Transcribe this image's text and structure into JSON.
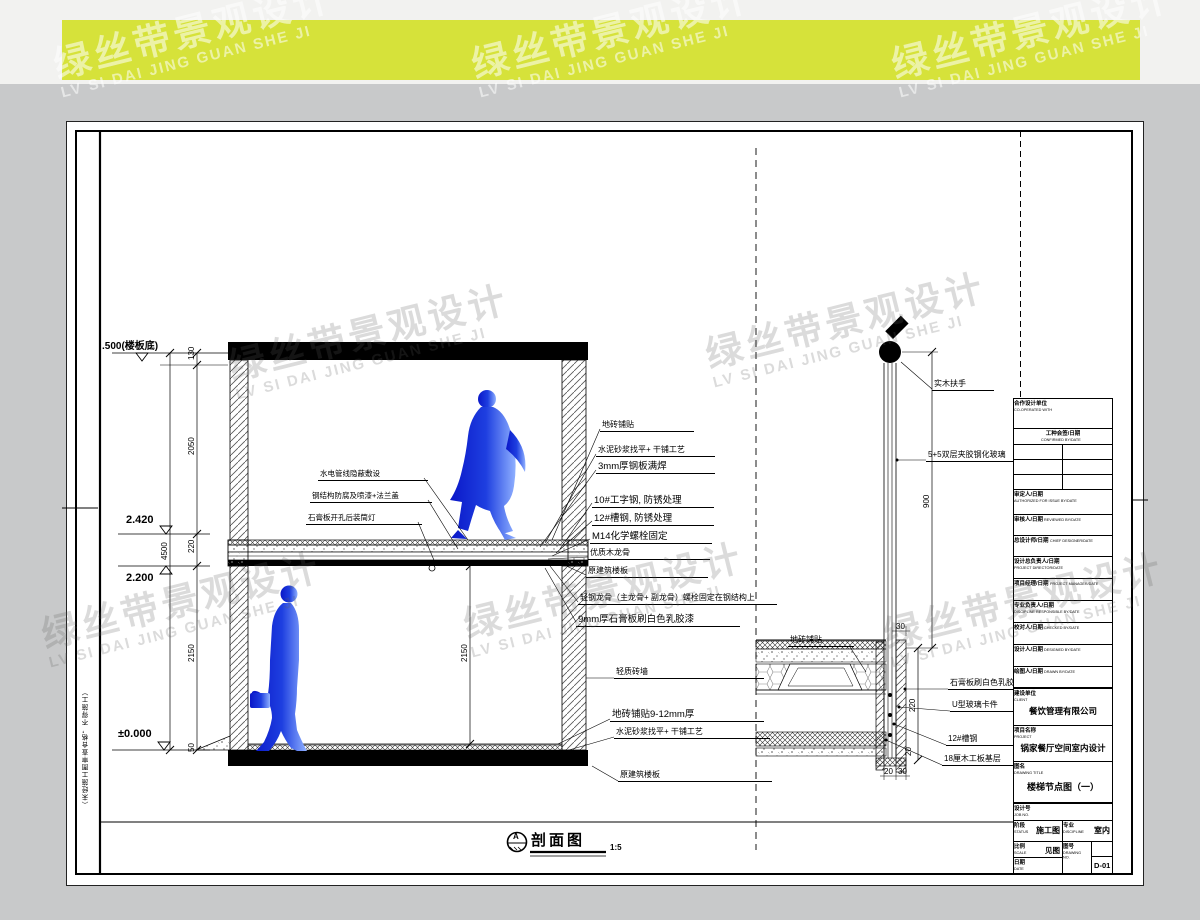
{
  "watermark": {
    "cn": "绿丝带景观设计",
    "en": "LV SI DAI JING GUAN SHE JI"
  },
  "elev": {
    "top": ".500(楼板底)",
    "mid_upper": "2.420",
    "mid_lower": "2.200",
    "zero": "±0.000"
  },
  "dims_left": {
    "s130": "130",
    "s2050": "2050",
    "s220": "220",
    "s2150": "2150",
    "s50": "50",
    "total": "4500"
  },
  "sec_mid_dim": "2150",
  "secL": [
    "水电管线隐蔽敷设",
    "钢结构防腐及喷漆+法兰盖",
    "石膏板开孔后装筒灯"
  ],
  "secR": [
    "地砖铺贴",
    "水泥砂浆找平+ 干铺工艺",
    "3mm厚钢板满焊",
    "10#工字钢, 防锈处理",
    "12#槽钢, 防锈处理",
    "M14化学螺栓固定",
    "优质木龙骨",
    "原建筑楼板",
    "轻钢龙骨（主龙骨+ 副龙骨）螺栓固定在钢结构上",
    "9mm厚石膏板刷白色乳胶漆"
  ],
  "secB": [
    "轻质砖墙",
    "地砖铺贴9-12mm厚",
    "水泥砂浆找平+ 干铺工艺",
    "原建筑楼板"
  ],
  "det": {
    "handrail": "实木扶手",
    "glass": "5+5双层夹胶钢化玻璃",
    "tile": "地砖铺贴",
    "gypsum": "石膏板刷白色乳胶漆",
    "clip": "U型玻璃卡件",
    "channel": "12#槽钢",
    "plywood": "18厘木工板基层"
  },
  "detDims": {
    "dia": "Φ50",
    "h900": "900",
    "d30": "30",
    "d220": "220",
    "d20": "20",
    "b20": "20",
    "b30": "30"
  },
  "view_title": {
    "mark": "A",
    "name": "剖面图",
    "scale": "1:5"
  },
  "side_note": "（未经施工图审查合格，不得施工）",
  "tb": {
    "coop_cn": "合作设计单位",
    "coop_en": "CO-OPERATED WITH",
    "confirm_cn": "工种会签/日期",
    "confirm_en": "CONFIRMED BY/DATE",
    "rows": [
      {
        "cn": "审定人/日期",
        "en": "AUTHORIZED FOR ISSUE BY/DATE"
      },
      {
        "cn": "审核人/日期",
        "en": "REVIEWED BY/DATE"
      },
      {
        "cn": "总设计师/日期",
        "en": "CHIEF DESIGNER/DATE"
      },
      {
        "cn": "设计总负责人/日期",
        "en": "PROJECT DIRECTOR/DATE"
      },
      {
        "cn": "项目经理/日期",
        "en": "PROJECT MANAGER/DATE"
      },
      {
        "cn": "专业负责人/日期",
        "en": "DISCIPLINE RESPONSIBLE BY/DATE"
      },
      {
        "cn": "校对人/日期",
        "en": "CHECKED BY/DATE"
      },
      {
        "cn": "设计人/日期",
        "en": "DESIGNED BY/DATE"
      },
      {
        "cn": "绘图人/日期",
        "en": "DRAWN BY/DATE"
      }
    ],
    "client_cn": "建设单位",
    "client_en": "CLIENT",
    "client": "餐饮管理有限公司",
    "project_cn": "项目名称",
    "project_en": "PROJECT",
    "project": "锅家餐厅空间室内设计",
    "title_cn": "图名",
    "title_en": "DRAWING TITLE",
    "title": "楼梯节点图（一）",
    "job_cn": "设计号",
    "job_en": "JOB NO.",
    "status_cn": "阶段",
    "status_en": "STATUS",
    "status": "施工图",
    "disc_cn": "专业",
    "disc_en": "DISCIPLINE",
    "disc": "室内",
    "scale_cn": "比例",
    "scale_en": "SCALE",
    "scale": "见图",
    "no_cn": "图号",
    "no_en": "DRAWING NO.",
    "no": "D-01",
    "date_cn": "日期",
    "date_en": "DATE"
  }
}
